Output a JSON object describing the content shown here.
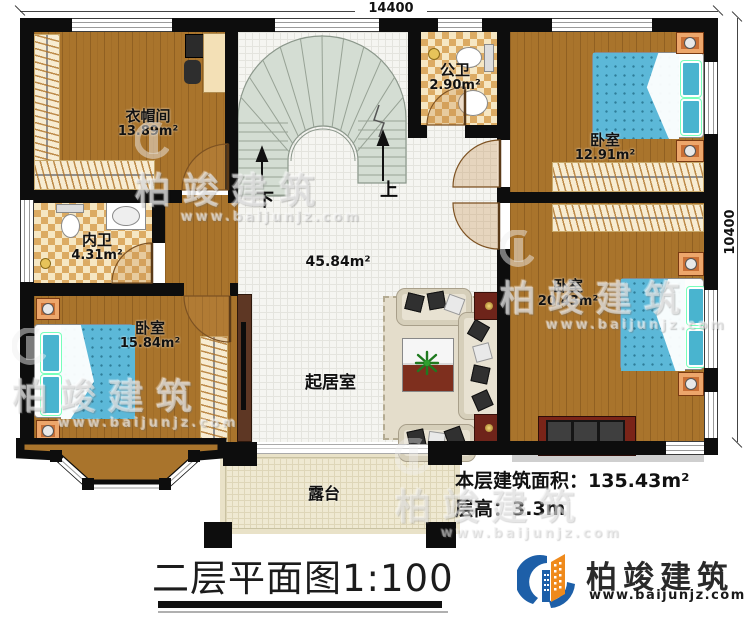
{
  "dimensions": {
    "width_label": "14400",
    "height_label": "10400"
  },
  "rooms": {
    "cloakroom": {
      "name": "衣帽间",
      "area": "13.89m²"
    },
    "inner_bath": {
      "name": "内卫",
      "area": "4.31m²"
    },
    "public_bath": {
      "name": "公卫",
      "area": "2.90m²"
    },
    "bedroom_top_right": {
      "name": "卧室",
      "area": "12.91m²"
    },
    "bedroom_right": {
      "name": "卧室",
      "area": "20.43m²"
    },
    "bedroom_bottom_left": {
      "name": "卧室",
      "area": "15.84m²"
    },
    "living_room": {
      "name": "起居室",
      "area": "45.84m²"
    },
    "terrace": {
      "name": "露台"
    }
  },
  "stairs": {
    "down_label": "下",
    "up_label": "上"
  },
  "floor_info": {
    "area_label": "本层建筑面积：",
    "area_value": "135.43m²",
    "height_label": "层高：",
    "height_value": "3.3m"
  },
  "title": {
    "name": "二层平面图",
    "scale": "1:100"
  },
  "brand": {
    "name": "柏竣建筑",
    "website": "www.baijunjz.com"
  },
  "watermark": {
    "name": "柏竣建筑",
    "website": "www.baijunjz.com"
  },
  "colors": {
    "wall": "#0d0d0d",
    "wood": "#a9742c",
    "tile_dark": "#dcab63",
    "tile_light": "#f6e7c3",
    "stairs": "#d4ddd3",
    "living_floor": "#f5f5f1",
    "terrace": "#efe9d2",
    "bed_blue": "#5cb8d8",
    "accent_orange": "#ef8a1c",
    "accent_blue": "#1d5fa8"
  }
}
